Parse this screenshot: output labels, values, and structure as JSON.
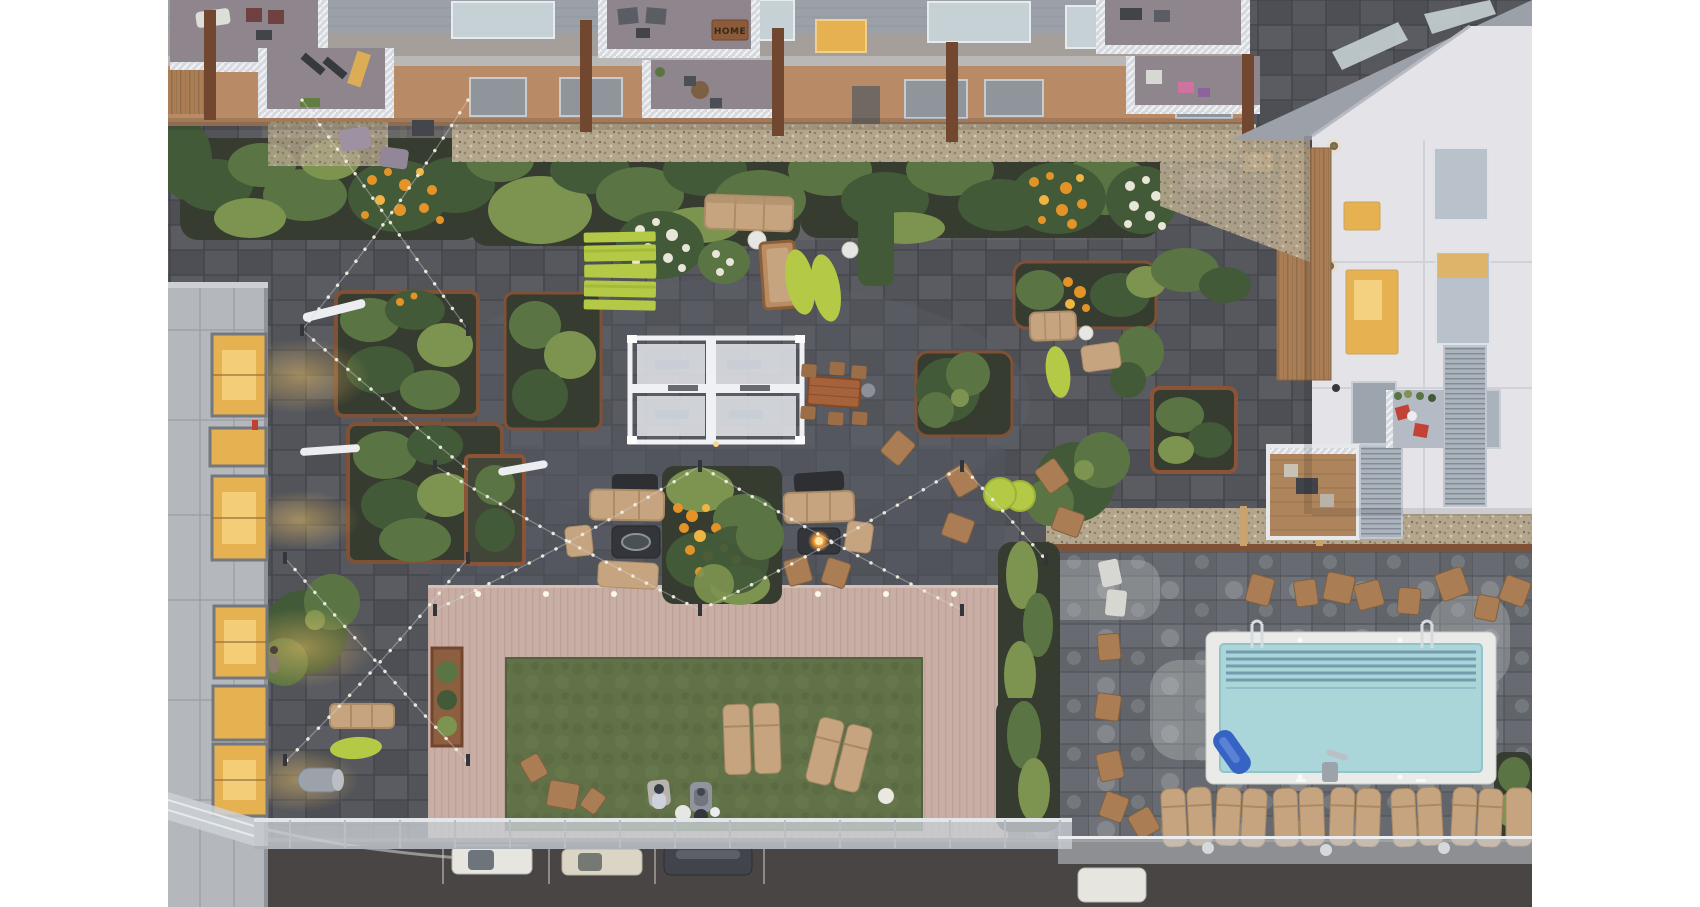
{
  "scene": {
    "description": "Aerial dusk photograph of an apartment-complex courtyard amenity terrace: dark paver plaza with planters and string lights, white pergola over game tables, lime-green picnic tables, fire-pit lounges, composite deck framing an artificial lawn with chaise loungers and two people, and a swimming-pool terrace with a row of wicker loungers beside a street with parked cars.",
    "home_mat_text": "HOME",
    "people_on_lawn": 2,
    "parked_cars": 4,
    "objects": [
      "apartment building facades",
      "balconies with white railings",
      "HOME doormat",
      "wood privacy fences",
      "gravel strips",
      "planters with shrubs",
      "orange flowers",
      "white hydrangeas",
      "white pergola over table-tennis tables",
      "lime picnic tables",
      "lime oval rugs",
      "outdoor sofas",
      "fire tables (one lit)",
      "covered bbq grills",
      "string lights on poles",
      "adirondack chairs",
      "wood dining set",
      "composite deck",
      "artificial lawn",
      "chaise loungers",
      "wood folding chairs",
      "swimming pool",
      "pool ladders",
      "blue pool float",
      "accessible pool lift",
      "wicker double loungers",
      "glass entry canopy",
      "street with parked cars",
      "louvered balcony screens",
      "lit apartment windows",
      "tree canopies",
      "accent light bars"
    ]
  },
  "palette": {
    "paver_dark": "#4c4e53",
    "paver_grout": "#3e4045",
    "paver_light": "#5d6067",
    "pool_paver": "#63676c",
    "pool_paver_stain": "#9ba0a2",
    "street": "#433f3e",
    "curb": "#c9ccd0",
    "deck": "#c9ada2",
    "deck_stripe": "#bda197",
    "lawn": "#5d6e41",
    "lawn_dark": "#556539",
    "pool_water": "#a9d6da",
    "pool_lane": "#56839b",
    "pool_coping": "#eceee9",
    "lime": "#b4ca3e",
    "tan": "#c7a37c",
    "tan_dark": "#ab8a60",
    "wood": "#a97a4e",
    "wood_dark": "#7c4b2e",
    "corten": "#8a4f2e",
    "green_dark": "#3d5530",
    "green_mid": "#55713c",
    "green_light": "#7a9149",
    "flower_orange": "#e6921e",
    "flower_white": "#e9e8d8",
    "soil": "#2f3526",
    "facade_white": "#e6e6e9",
    "facade_gray": "#a49e98",
    "facade_tan": "#b8875f",
    "balcony_floor": "#8c8289",
    "railing": "#e8ebee",
    "roof": "#9aa0a7",
    "window_glass": "#c6d2d4",
    "window_amber": "#e8b04a",
    "amber_glow": "#f3c35f",
    "louver": "#aab3bc",
    "gravel": "#b3a58a",
    "grill_black": "#26282b",
    "fire_orange": "#ff9b2e",
    "float_blue": "#2f5fc4",
    "car_white": "#e9e7e1",
    "car_cream": "#ddd6c6",
    "car_dark": "#3a3e44",
    "canopy_glass": "#c9ced3"
  }
}
